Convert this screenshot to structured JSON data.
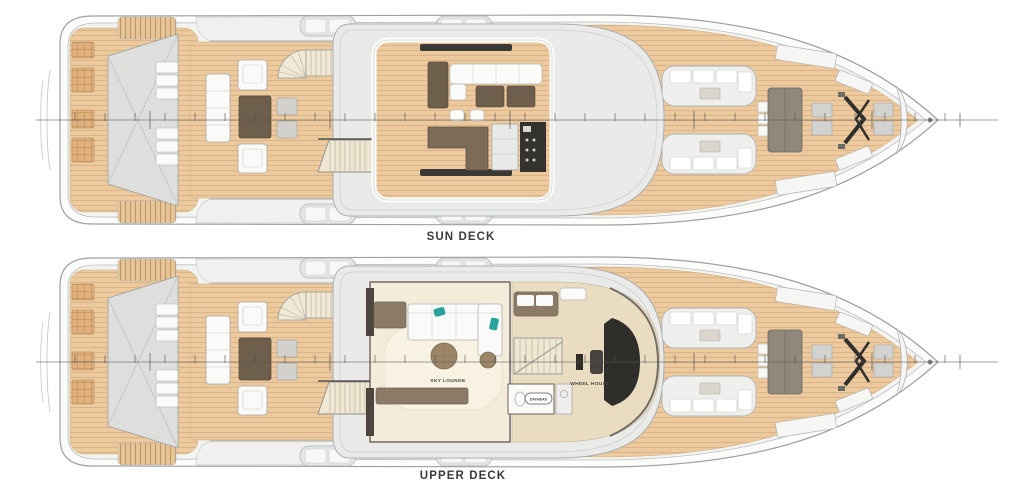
{
  "diagram": {
    "kind": "yacht-general-arrangement-plan",
    "orientation": "bow-right",
    "background": "#ffffff"
  },
  "decks": [
    {
      "id": "sun-deck",
      "label": "SUN DECK",
      "features": [
        "aft-sun-pads",
        "tender-garage-hatch",
        "sun-loungers",
        "lounge-seating",
        "spiral-staircase",
        "open-bar-with-grill",
        "hardtop",
        "bow-seating",
        "foredeck-sun-pad",
        "anchor-windlass"
      ]
    },
    {
      "id": "upper-deck",
      "label": "UPPER DECK",
      "rooms": {
        "sky_lounge": "SKY LOUNGE",
        "wheel_house": "WHEEL HOUSE",
        "dayhead": "DAYHEAD"
      },
      "features": [
        "aft-sun-pads",
        "tender-garage-hatch",
        "sun-loungers",
        "lounge-seating",
        "spiral-staircase",
        "sky-lounge",
        "wheel-house",
        "dayhead",
        "helm-console",
        "bow-seating",
        "foredeck-sun-pad",
        "anchor-windlass"
      ]
    }
  ],
  "colors": {
    "background": "#ffffff",
    "deck_wood": "#ecca9e",
    "plank_line": "#d9b186",
    "hull_outline": "#9ba1a4",
    "bulwark_fill": "#f3f3f1",
    "superstructure_gray": "#eaeae8",
    "furniture_brown": "#6e5e4c",
    "furniture_taupe": "#8b7b66",
    "appliance_black": "#34322e",
    "teal_accent": "#27a39b",
    "cream_floor": "#f3ecdb",
    "sunpad_tan": "#e0b17c",
    "label_text": "#3b3b3b"
  }
}
